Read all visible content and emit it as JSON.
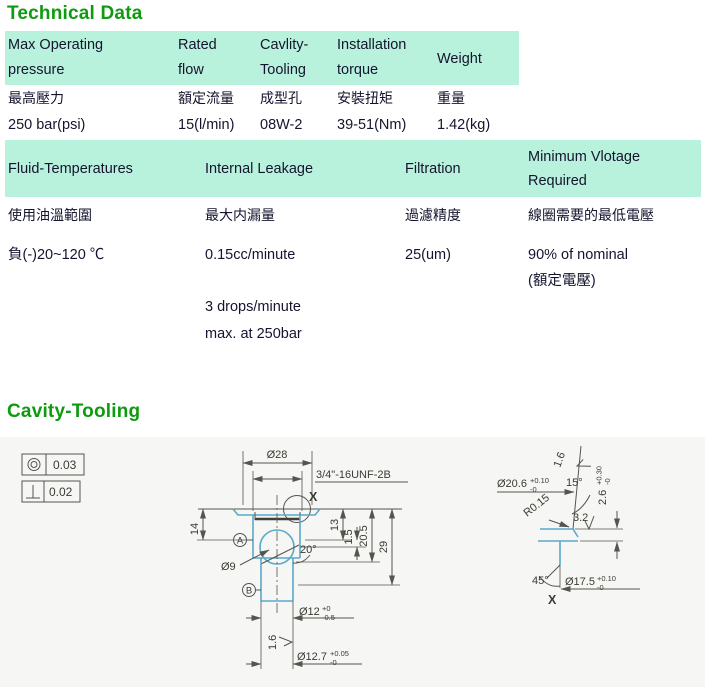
{
  "sections": {
    "technical_data": "Technical Data",
    "cavity_tooling": "Cavity-Tooling"
  },
  "colors": {
    "title_green": "#0f9b0f",
    "table_header_bg": "#b8f2dd",
    "drawing_bg": "#f6f6f4",
    "profile_blue": "#5aa9c9",
    "line_gray": "#54554e"
  },
  "table1": {
    "headers": [
      "Max Operating pressure",
      "Rated flow",
      "Cavlity-Tooling",
      "Installation torque",
      "Weight"
    ],
    "headers_zh": [
      "最高壓力",
      "額定流量",
      "成型孔",
      "安裝扭矩",
      "重量"
    ],
    "values": [
      "250 bar(psi)",
      "15(l/min)",
      "08W-2",
      "39-51(Nm)",
      "1.42(kg)"
    ]
  },
  "table2": {
    "headers": [
      "Fluid-Temperatures",
      "Internal Leakage",
      "Filtration",
      "Minimum Vlotage Required"
    ],
    "headers_zh": [
      "使用油溫範圍",
      "最大内漏量",
      "過濾精度",
      "線圈需要的最低電壓"
    ],
    "values": [
      "負(-)20~120 ℃",
      "0.15cc/minute",
      "25(um)",
      "90% of nominal"
    ],
    "value4_note": "(額定電壓)",
    "leakage_extra": [
      "3 drops/minute",
      "max. at 250bar"
    ]
  },
  "drawing": {
    "tolerance_boxes": [
      {
        "symbol": "concentricity",
        "value": "0.03"
      },
      {
        "symbol": "perpendicularity",
        "value": "0.02"
      }
    ],
    "labels": {
      "d28": "Ø28",
      "thread": "3/4\"-16UNF-2B",
      "x_marker": "X",
      "dim14": "14",
      "dim13": "13",
      "dim1_5": "1.5",
      "dim20_5": "20.5",
      "dim29": "29",
      "angle20": "20°",
      "d9": "Ø9",
      "datum_a": "A",
      "datum_b": "B",
      "finish1_6": "1.6",
      "d12": "Ø12",
      "d12_top": "+0",
      "d12_bot": "-0.5",
      "d12_7": "Ø12.7",
      "d12_7_top": "+0.05",
      "d12_7_bot": "-0",
      "d20_6": "Ø20.6",
      "d20_6_top": "+0.10",
      "d20_6_bot": "-0",
      "angle15": "15°",
      "dim2_6": "2.6",
      "dim2_6_top": "+0.30",
      "dim2_6_bot": "-0",
      "r0_15": "R0.15",
      "finish3_2": "3.2",
      "angle45": "45°",
      "d17_5": "Ø17.5",
      "d17_5_top": "+0.10",
      "d17_5_bot": "-0",
      "x_detail": "X"
    }
  }
}
